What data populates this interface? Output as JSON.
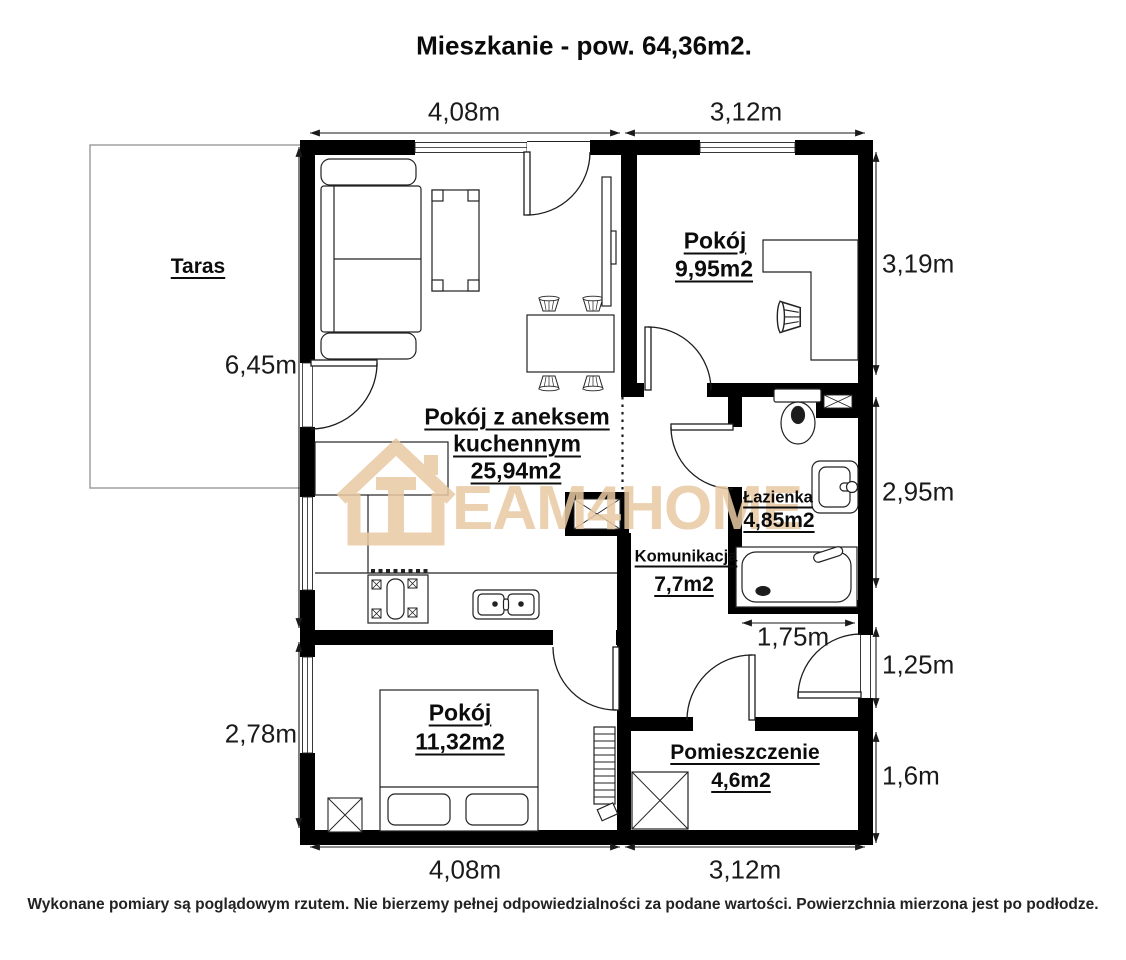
{
  "title": "Mieszkanie - pow. 64,36m2.",
  "footer": "Wykonane pomiary są poglądowym rzutem. Nie bierzemy pełnej odpowiedzialności za podane wartości. Powierzchnia mierzona jest po podłodze.",
  "watermark": {
    "letters": "EAM4HOME",
    "color": "#e8c9a3"
  },
  "rooms": {
    "taras": {
      "name": "Taras"
    },
    "pokoj_gorny": {
      "name": "Pokój",
      "area": "9,95m2"
    },
    "salon": {
      "name_line1": "Pokój z aneksem",
      "name_line2": "kuchennym",
      "area": "25,94m2"
    },
    "lazienka": {
      "name": "Łazienka",
      "area": "4,85m2"
    },
    "komunikacja": {
      "name": "Komunikacja",
      "area": "7,7m2"
    },
    "sypialnia": {
      "name": "Pokój",
      "area": "11,32m2"
    },
    "pomieszczenie": {
      "name": "Pomieszczenie",
      "area": "4,6m2"
    }
  },
  "dimensions": {
    "top_left": "4,08m",
    "top_right": "3,12m",
    "bottom_left": "4,08m",
    "bottom_right": "3,12m",
    "left_upper": "6,45m",
    "left_lower": "2,78m",
    "right_1": "3,19m",
    "right_2": "2,95m",
    "right_3": "1,25m",
    "right_4": "1,6m",
    "hall_width": "1,75m"
  }
}
